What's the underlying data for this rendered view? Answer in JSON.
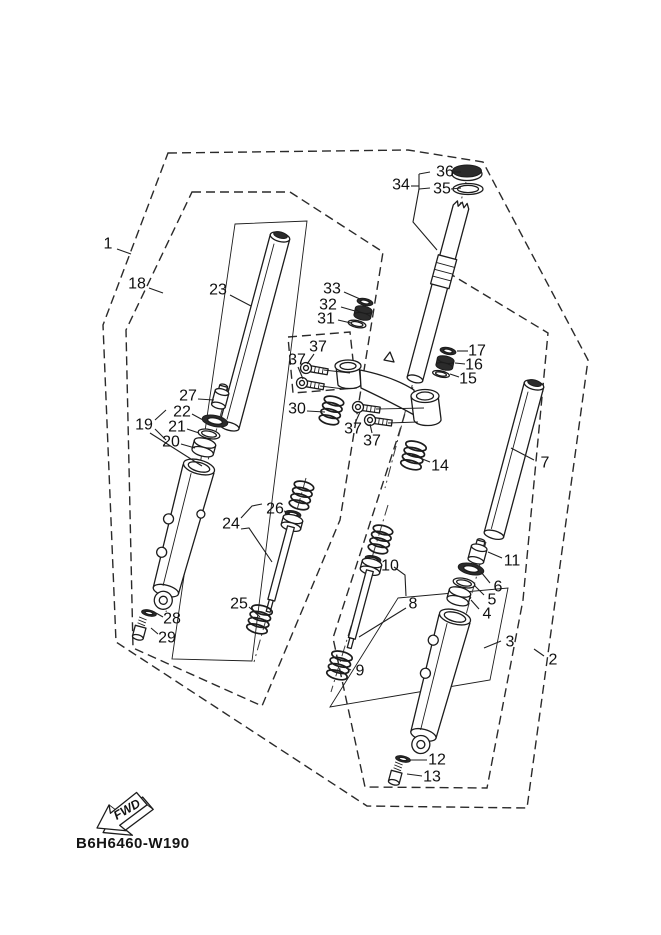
{
  "diagram": {
    "code": "B6H6460-W190",
    "fwd_label": "FWD",
    "line_color": "#1c1c1c",
    "bg_color": "#ffffff",
    "callouts": [
      {
        "n": "1",
        "x": 108,
        "y": 244,
        "leaders": [
          [
            [
              117,
              249
            ],
            [
              131,
              254
            ]
          ]
        ]
      },
      {
        "n": "18",
        "x": 137,
        "y": 284,
        "leaders": [
          [
            [
              149,
              288
            ],
            [
              163,
              293
            ]
          ]
        ]
      },
      {
        "n": "23",
        "x": 218,
        "y": 290,
        "leaders": [
          [
            [
              230,
              295
            ],
            [
              251,
              306
            ]
          ]
        ]
      },
      {
        "n": "33",
        "x": 332,
        "y": 289,
        "leaders": [
          [
            [
              344,
              292
            ],
            [
              360,
              299
            ]
          ]
        ]
      },
      {
        "n": "32",
        "x": 328,
        "y": 305,
        "leaders": [
          [
            [
              341,
              307
            ],
            [
              355,
              311
            ]
          ]
        ]
      },
      {
        "n": "31",
        "x": 326,
        "y": 319,
        "leaders": [
          [
            [
              338,
              320
            ],
            [
              351,
              323
            ]
          ]
        ]
      },
      {
        "n": "34",
        "x": 401,
        "y": 185,
        "leaders": [
          [
            [
              411,
              186
            ],
            [
              419,
              186
            ]
          ],
          [
            [
              419,
              174
            ],
            [
              419,
              190
            ]
          ],
          [
            [
              419,
              174
            ],
            [
              430,
              172
            ]
          ],
          [
            [
              419,
              189
            ],
            [
              430,
              188
            ]
          ],
          [
            [
              419,
              189
            ],
            [
              413,
              222
            ],
            [
              437,
              250
            ]
          ]
        ]
      },
      {
        "n": "36",
        "x": 445,
        "y": 172,
        "leaders": [
          [
            [
              454,
              172
            ],
            [
              461,
              172
            ]
          ]
        ]
      },
      {
        "n": "35",
        "x": 442,
        "y": 189,
        "leaders": [
          [
            [
              451,
              189
            ],
            [
              461,
              188
            ]
          ]
        ]
      },
      {
        "n": "17",
        "x": 477,
        "y": 351,
        "leaders": [
          [
            [
              468,
              351
            ],
            [
              457,
              351
            ]
          ]
        ]
      },
      {
        "n": "16",
        "x": 474,
        "y": 365,
        "leaders": [
          [
            [
              465,
              364
            ],
            [
              455,
              363
            ]
          ]
        ]
      },
      {
        "n": "15",
        "x": 468,
        "y": 379,
        "leaders": [
          [
            [
              459,
              377
            ],
            [
              450,
              374
            ]
          ]
        ]
      },
      {
        "n": "37",
        "x": 318,
        "y": 347,
        "leaders": [
          [
            [
              314,
              354
            ],
            [
              307,
              364
            ]
          ]
        ]
      },
      {
        "n": "37",
        "x": 297,
        "y": 360,
        "leaders": [
          [
            [
              298,
              367
            ],
            [
              303,
              379
            ]
          ]
        ]
      },
      {
        "n": "27",
        "x": 188,
        "y": 396,
        "leaders": [
          [
            [
              198,
              399
            ],
            [
              214,
              400
            ]
          ]
        ]
      },
      {
        "n": "22",
        "x": 182,
        "y": 412,
        "leaders": [
          [
            [
              192,
              414
            ],
            [
              203,
              420
            ]
          ]
        ]
      },
      {
        "n": "19",
        "x": 144,
        "y": 425,
        "leaders": [
          [
            [
              155,
              420
            ],
            [
              166,
              410
            ]
          ],
          [
            [
              155,
              429
            ],
            [
              166,
              440
            ]
          ],
          [
            [
              150,
              433
            ],
            [
              202,
              466
            ]
          ]
        ]
      },
      {
        "n": "21",
        "x": 177,
        "y": 427,
        "leaders": [
          [
            [
              187,
              429
            ],
            [
              199,
              433
            ]
          ]
        ]
      },
      {
        "n": "20",
        "x": 171,
        "y": 442,
        "leaders": [
          [
            [
              181,
              444
            ],
            [
              195,
              448
            ]
          ]
        ]
      },
      {
        "n": "30",
        "x": 297,
        "y": 409,
        "leaders": [
          [
            [
              307,
              411
            ],
            [
              325,
              412
            ]
          ]
        ]
      },
      {
        "n": "37",
        "x": 353,
        "y": 429,
        "leaders": [
          [
            [
              356,
              421
            ],
            [
              360,
              412
            ]
          ]
        ]
      },
      {
        "n": "37",
        "x": 372,
        "y": 441,
        "leaders": [
          [
            [
              372,
              433
            ],
            [
              370,
              424
            ]
          ]
        ]
      },
      {
        "n": "14",
        "x": 440,
        "y": 466,
        "leaders": [
          [
            [
              430,
              462
            ],
            [
              412,
              455
            ]
          ]
        ]
      },
      {
        "n": "7",
        "x": 545,
        "y": 463,
        "leaders": [
          [
            [
              534,
              460
            ],
            [
              511,
              448
            ]
          ]
        ]
      },
      {
        "n": "26",
        "x": 275,
        "y": 509,
        "leaders": [
          [
            [
              284,
              511
            ],
            [
              290,
              513
            ]
          ]
        ]
      },
      {
        "n": "24",
        "x": 231,
        "y": 524,
        "leaders": [
          [
            [
              241,
              518
            ],
            [
              252,
              506
            ],
            [
              262,
              504
            ]
          ],
          [
            [
              241,
              529
            ],
            [
              249,
              528
            ],
            [
              272,
              562
            ]
          ]
        ]
      },
      {
        "n": "11",
        "x": 512,
        "y": 561,
        "leaders": [
          [
            [
              502,
              558
            ],
            [
              488,
              552
            ]
          ]
        ]
      },
      {
        "n": "10",
        "x": 390,
        "y": 566,
        "leaders": [
          [
            [
              381,
              563
            ],
            [
              376,
              560
            ]
          ]
        ]
      },
      {
        "n": "6",
        "x": 498,
        "y": 587,
        "leaders": [
          [
            [
              490,
              583
            ],
            [
              481,
              572
            ]
          ]
        ]
      },
      {
        "n": "5",
        "x": 492,
        "y": 600,
        "leaders": [
          [
            [
              484,
              595
            ],
            [
              474,
              585
            ]
          ]
        ]
      },
      {
        "n": "8",
        "x": 413,
        "y": 604,
        "leaders": [
          [
            [
              406,
              596
            ],
            [
              405,
              575
            ],
            [
              394,
              567
            ]
          ],
          [
            [
              406,
              608
            ],
            [
              359,
              637
            ]
          ]
        ]
      },
      {
        "n": "4",
        "x": 487,
        "y": 614,
        "leaders": [
          [
            [
              479,
              609
            ],
            [
              471,
              600
            ]
          ]
        ]
      },
      {
        "n": "25",
        "x": 239,
        "y": 604,
        "leaders": [
          [
            [
              249,
              607
            ],
            [
              260,
              617
            ]
          ]
        ]
      },
      {
        "n": "3",
        "x": 510,
        "y": 642,
        "leaders": [
          [
            [
              501,
              641
            ],
            [
              484,
              648
            ]
          ]
        ]
      },
      {
        "n": "2",
        "x": 553,
        "y": 660,
        "leaders": [
          [
            [
              544,
              656
            ],
            [
              534,
              649
            ]
          ]
        ]
      },
      {
        "n": "28",
        "x": 172,
        "y": 619,
        "leaders": [
          [
            [
              163,
              617
            ],
            [
              156,
              613
            ]
          ]
        ]
      },
      {
        "n": "29",
        "x": 167,
        "y": 638,
        "leaders": [
          [
            [
              158,
              634
            ],
            [
              151,
              628
            ]
          ]
        ]
      },
      {
        "n": "9",
        "x": 360,
        "y": 671,
        "leaders": [
          [
            [
              351,
              670
            ],
            [
              346,
              668
            ]
          ]
        ]
      },
      {
        "n": "12",
        "x": 437,
        "y": 760,
        "leaders": [
          [
            [
              427,
              760
            ],
            [
              410,
              760
            ]
          ]
        ]
      },
      {
        "n": "13",
        "x": 432,
        "y": 777,
        "leaders": [
          [
            [
              422,
              776
            ],
            [
              407,
              774
            ]
          ]
        ]
      }
    ]
  }
}
